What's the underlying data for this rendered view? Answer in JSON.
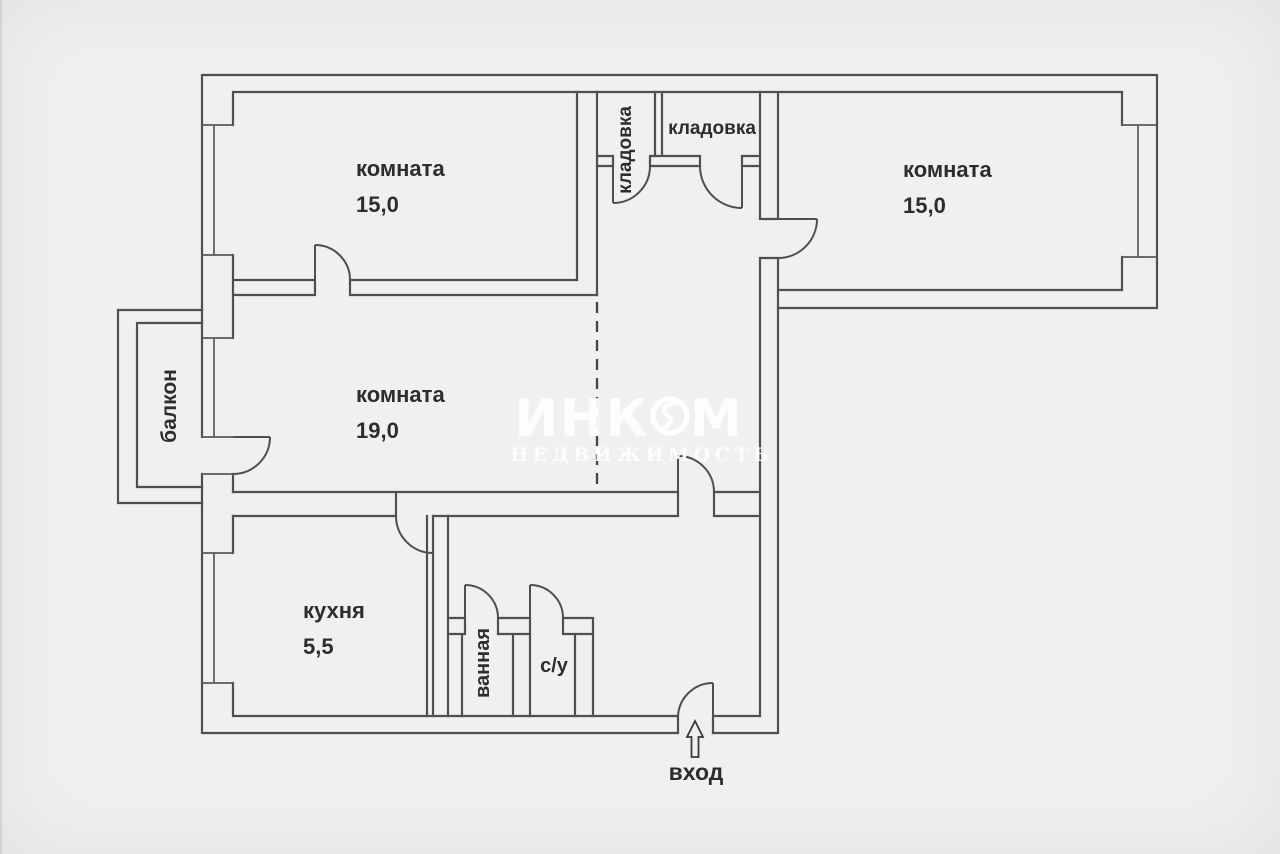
{
  "page": {
    "background": "#f1f0ee",
    "line_color": "#4f4f4f",
    "label_color": "#2d2d2d",
    "watermark_color": "#ffffff"
  },
  "rooms": [
    {
      "name": "комната",
      "area": "15,0"
    },
    {
      "name": "комната",
      "area": "15,0"
    },
    {
      "name": "комната",
      "area": "19,0"
    },
    {
      "name": "кухня",
      "area": "5,5"
    },
    {
      "name": "кладовка"
    },
    {
      "name": "кладовка"
    },
    {
      "name": "балкон"
    },
    {
      "name": "ванная"
    },
    {
      "name": "с/у"
    }
  ],
  "entrance": {
    "label": "вход"
  },
  "watermark": {
    "brand": "ИНКОМ",
    "brand_left": "ИНК",
    "brand_right": "М",
    "subtitle": "НЕДВИЖИМОСТЬ"
  }
}
